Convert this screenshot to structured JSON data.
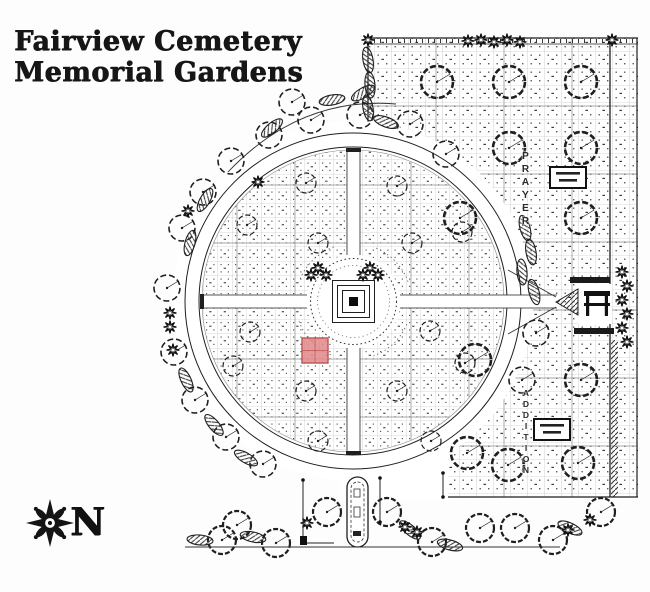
{
  "title": {
    "line1": "Fairview Cemetery",
    "line2": "Memorial Gardens"
  },
  "compass": {
    "label": "N"
  },
  "map": {
    "paper": "#ffffff",
    "ink": "#1f1f1f",
    "grid_color": "#ababab",
    "block_color": "#8a8a8a",
    "labels": {
      "prayer": "PRAYER",
      "addition": "ADDITION"
    },
    "highlight_plot": {
      "x": 302,
      "y": 338,
      "w": 26,
      "h": 25,
      "fill": "#e28b8b",
      "stroke": "#bb5555"
    },
    "circle": {
      "cx": 353,
      "cy": 301,
      "r_outer": 168,
      "r_inner": 154,
      "r_plots": 151,
      "r_gap": 180
    },
    "section": {
      "x": 368,
      "y": 38,
      "x2": 638,
      "y2": 497,
      "heavy_x": 610,
      "bottom_left_x": 445
    },
    "trees_inner": [
      [
        306,
        183
      ],
      [
        247,
        225
      ],
      [
        318,
        243
      ],
      [
        397,
        186
      ],
      [
        462,
        232
      ],
      [
        412,
        243
      ],
      [
        250,
        332
      ],
      [
        233,
        366
      ],
      [
        306,
        391
      ],
      [
        318,
        441
      ],
      [
        430,
        331
      ],
      [
        465,
        363
      ],
      [
        397,
        391
      ],
      [
        431,
        441
      ]
    ],
    "trees_perimeter": [
      [
        410,
        124
      ],
      [
        360,
        115
      ],
      [
        311,
        120
      ],
      [
        269,
        135
      ],
      [
        231,
        161
      ],
      [
        203,
        192
      ],
      [
        182,
        228
      ],
      [
        167,
        288
      ],
      [
        174,
        352
      ],
      [
        195,
        400
      ],
      [
        226,
        437
      ],
      [
        263,
        464
      ],
      [
        292,
        102
      ],
      [
        446,
        154
      ],
      [
        536,
        333
      ],
      [
        522,
        380
      ]
    ],
    "trees_section": [
      [
        437,
        82
      ],
      [
        509,
        82
      ],
      [
        581,
        82
      ],
      [
        509,
        148
      ],
      [
        581,
        148
      ],
      [
        460,
        218
      ],
      [
        581,
        218
      ],
      [
        475,
        360
      ],
      [
        581,
        380
      ],
      [
        467,
        453
      ],
      [
        508,
        465
      ],
      [
        578,
        463
      ]
    ],
    "trees_bottom": [
      [
        222,
        540
      ],
      [
        237,
        525
      ],
      [
        276,
        543
      ],
      [
        327,
        512
      ],
      [
        387,
        512
      ],
      [
        432,
        542
      ],
      [
        480,
        528
      ],
      [
        515,
        528
      ],
      [
        553,
        540
      ],
      [
        601,
        512
      ]
    ],
    "hedges": [
      [
        272,
        128,
        -40
      ],
      [
        205,
        200,
        -60
      ],
      [
        190,
        243,
        -75
      ],
      [
        186,
        380,
        65
      ],
      [
        214,
        425,
        50
      ],
      [
        246,
        458,
        30
      ],
      [
        386,
        122,
        20
      ],
      [
        332,
        100,
        -10
      ],
      [
        363,
        93,
        -30
      ],
      [
        368,
        60,
        80
      ],
      [
        370,
        85,
        85
      ],
      [
        368,
        108,
        80
      ],
      [
        525,
        228,
        75
      ],
      [
        531,
        252,
        80
      ],
      [
        522,
        272,
        85
      ],
      [
        534,
        292,
        75
      ],
      [
        200,
        540,
        5
      ],
      [
        253,
        537,
        12
      ],
      [
        410,
        530,
        40
      ],
      [
        450,
        545,
        15
      ],
      [
        570,
        528,
        25
      ]
    ],
    "shrub_stars": [
      [
        368,
        40
      ],
      [
        468,
        41
      ],
      [
        481,
        40
      ],
      [
        494,
        42
      ],
      [
        507,
        40
      ],
      [
        520,
        42
      ],
      [
        612,
        40
      ],
      [
        170,
        313
      ],
      [
        170,
        327
      ],
      [
        173,
        350
      ],
      [
        258,
        182
      ],
      [
        188,
        211
      ],
      [
        622,
        272
      ],
      [
        627,
        286
      ],
      [
        622,
        300
      ],
      [
        627,
        314
      ],
      [
        622,
        328
      ],
      [
        627,
        342
      ],
      [
        307,
        523
      ],
      [
        405,
        527
      ],
      [
        417,
        532
      ],
      [
        568,
        530
      ],
      [
        590,
        520
      ],
      [
        318,
        268
      ],
      [
        326,
        275
      ],
      [
        311,
        275
      ],
      [
        370,
        268
      ],
      [
        378,
        275
      ],
      [
        363,
        275
      ]
    ],
    "label_boxes": [
      [
        550,
        167,
        36,
        21
      ],
      [
        534,
        419,
        36,
        21
      ]
    ],
    "pavilion": {
      "plaza": [
        578,
        284,
        34,
        40
      ],
      "tri": [
        [
          556,
          302
        ],
        [
          578,
          289
        ],
        [
          578,
          315
        ]
      ],
      "strip_top": [
        570,
        277,
        40,
        6
      ],
      "strip_bottom": [
        574,
        328,
        40,
        6
      ]
    },
    "entrance": {
      "oval": [
        347,
        477,
        21,
        70
      ],
      "lines": [
        [
          303,
          480,
          303,
          543
        ],
        [
          303,
          543,
          334,
          543
        ],
        [
          380,
          478,
          380,
          522
        ],
        [
          443,
          473,
          443,
          497
        ]
      ],
      "dots": [
        [
          380,
          478
        ],
        [
          380,
          522
        ],
        [
          443,
          473
        ],
        [
          443,
          497
        ],
        [
          303,
          480
        ]
      ],
      "corner": [
        300,
        536,
        7,
        9
      ]
    },
    "baseline": [
      185,
      547,
      560,
      547
    ]
  }
}
